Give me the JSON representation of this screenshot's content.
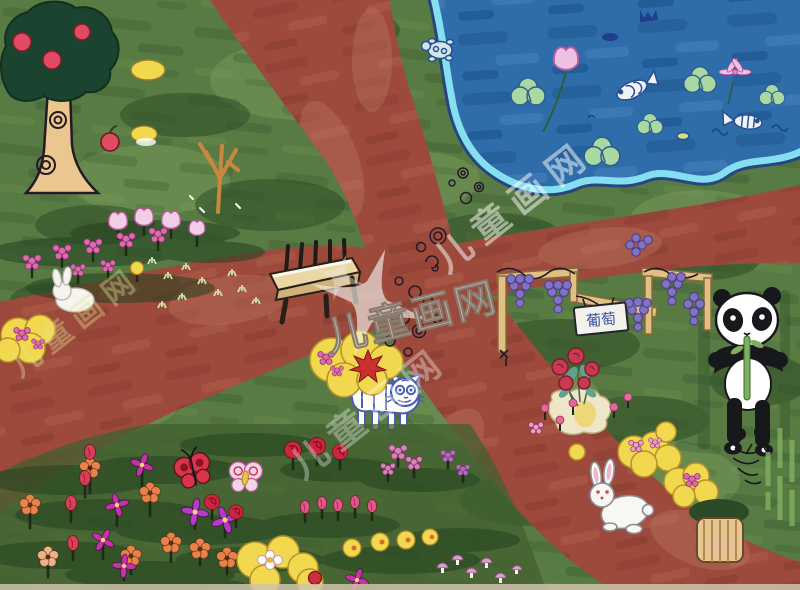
{
  "artwork": {
    "type": "children-marker-painting",
    "scene": "bird's-eye park scene: dark-red roads crossing in the middle, blue pond top-right, apple tree top-left, flower meadow and flower garden, grape trellis, bench and animals",
    "watermark": {
      "text": "儿童画网",
      "style": "repeated diagonal translucent watermark",
      "color": "#ffffff"
    },
    "sign": {
      "text": "葡萄",
      "color": "#3852a8"
    },
    "palette": {
      "grass": "#587a43",
      "grass_dark": "#2c4a25",
      "grass_light": "#8aa866",
      "road": "#9d4a3c",
      "road_dark": "#7c332b",
      "road_light": "#bd7763",
      "pond": "#2e6da9",
      "pond_dark": "#1d5590",
      "pond_edge": "#86dff0",
      "pond_outline": "#27457e",
      "tree_canopy": "#1b4430",
      "apple": "#e04b63",
      "trunk": "#ecc68f",
      "yellow": "#f2d84e",
      "wood": "#dcba7e",
      "bench_wood": "#ead7a4",
      "grape": "#8272c4",
      "magenta": "#c631a5",
      "pink": "#e06ab0",
      "orange_flower": "#e8824a",
      "red_flower": "#cc3040",
      "ink": "#241a26",
      "panda_black": "#17181c",
      "tiger_blue": "#4b5cb0",
      "white": "#ffffff"
    },
    "objects": [
      "apple-tree",
      "bare-tree",
      "pond",
      "lily-pads",
      "lotus-flowers",
      "fish",
      "turtle",
      "crossing-red-roads",
      "stone-doodles",
      "wooden-bench",
      "flower-meadow",
      "meadow-rabbit",
      "grape-trellis",
      "grape-sign",
      "panda-with-bamboo",
      "rose-bouquet",
      "tiger-cub",
      "yellow-bushes",
      "garden-rabbit",
      "flower-garden",
      "butterflies",
      "mushrooms",
      "tree-stump",
      "ink-bird",
      "bamboo-stalks"
    ]
  }
}
